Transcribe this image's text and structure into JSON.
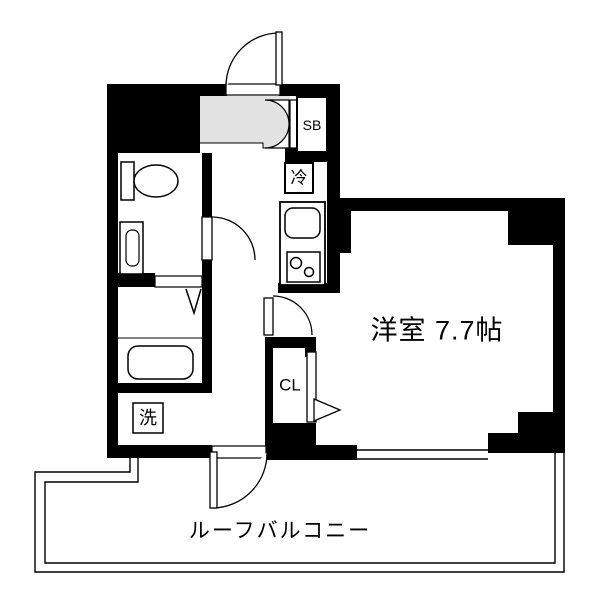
{
  "floorplan": {
    "rooms": {
      "main_room_label": "洋室 7.7帖",
      "balcony_label": "ルーフバルコニー"
    },
    "fixtures": {
      "shoe_box_label": "SB",
      "refrigerator_label": "冷",
      "closet_label": "CL",
      "washing_machine_label": "洗"
    },
    "colors": {
      "wall": "#000000",
      "entrance_floor": "#e2e2e2",
      "background": "#ffffff",
      "line": "#000000"
    }
  }
}
